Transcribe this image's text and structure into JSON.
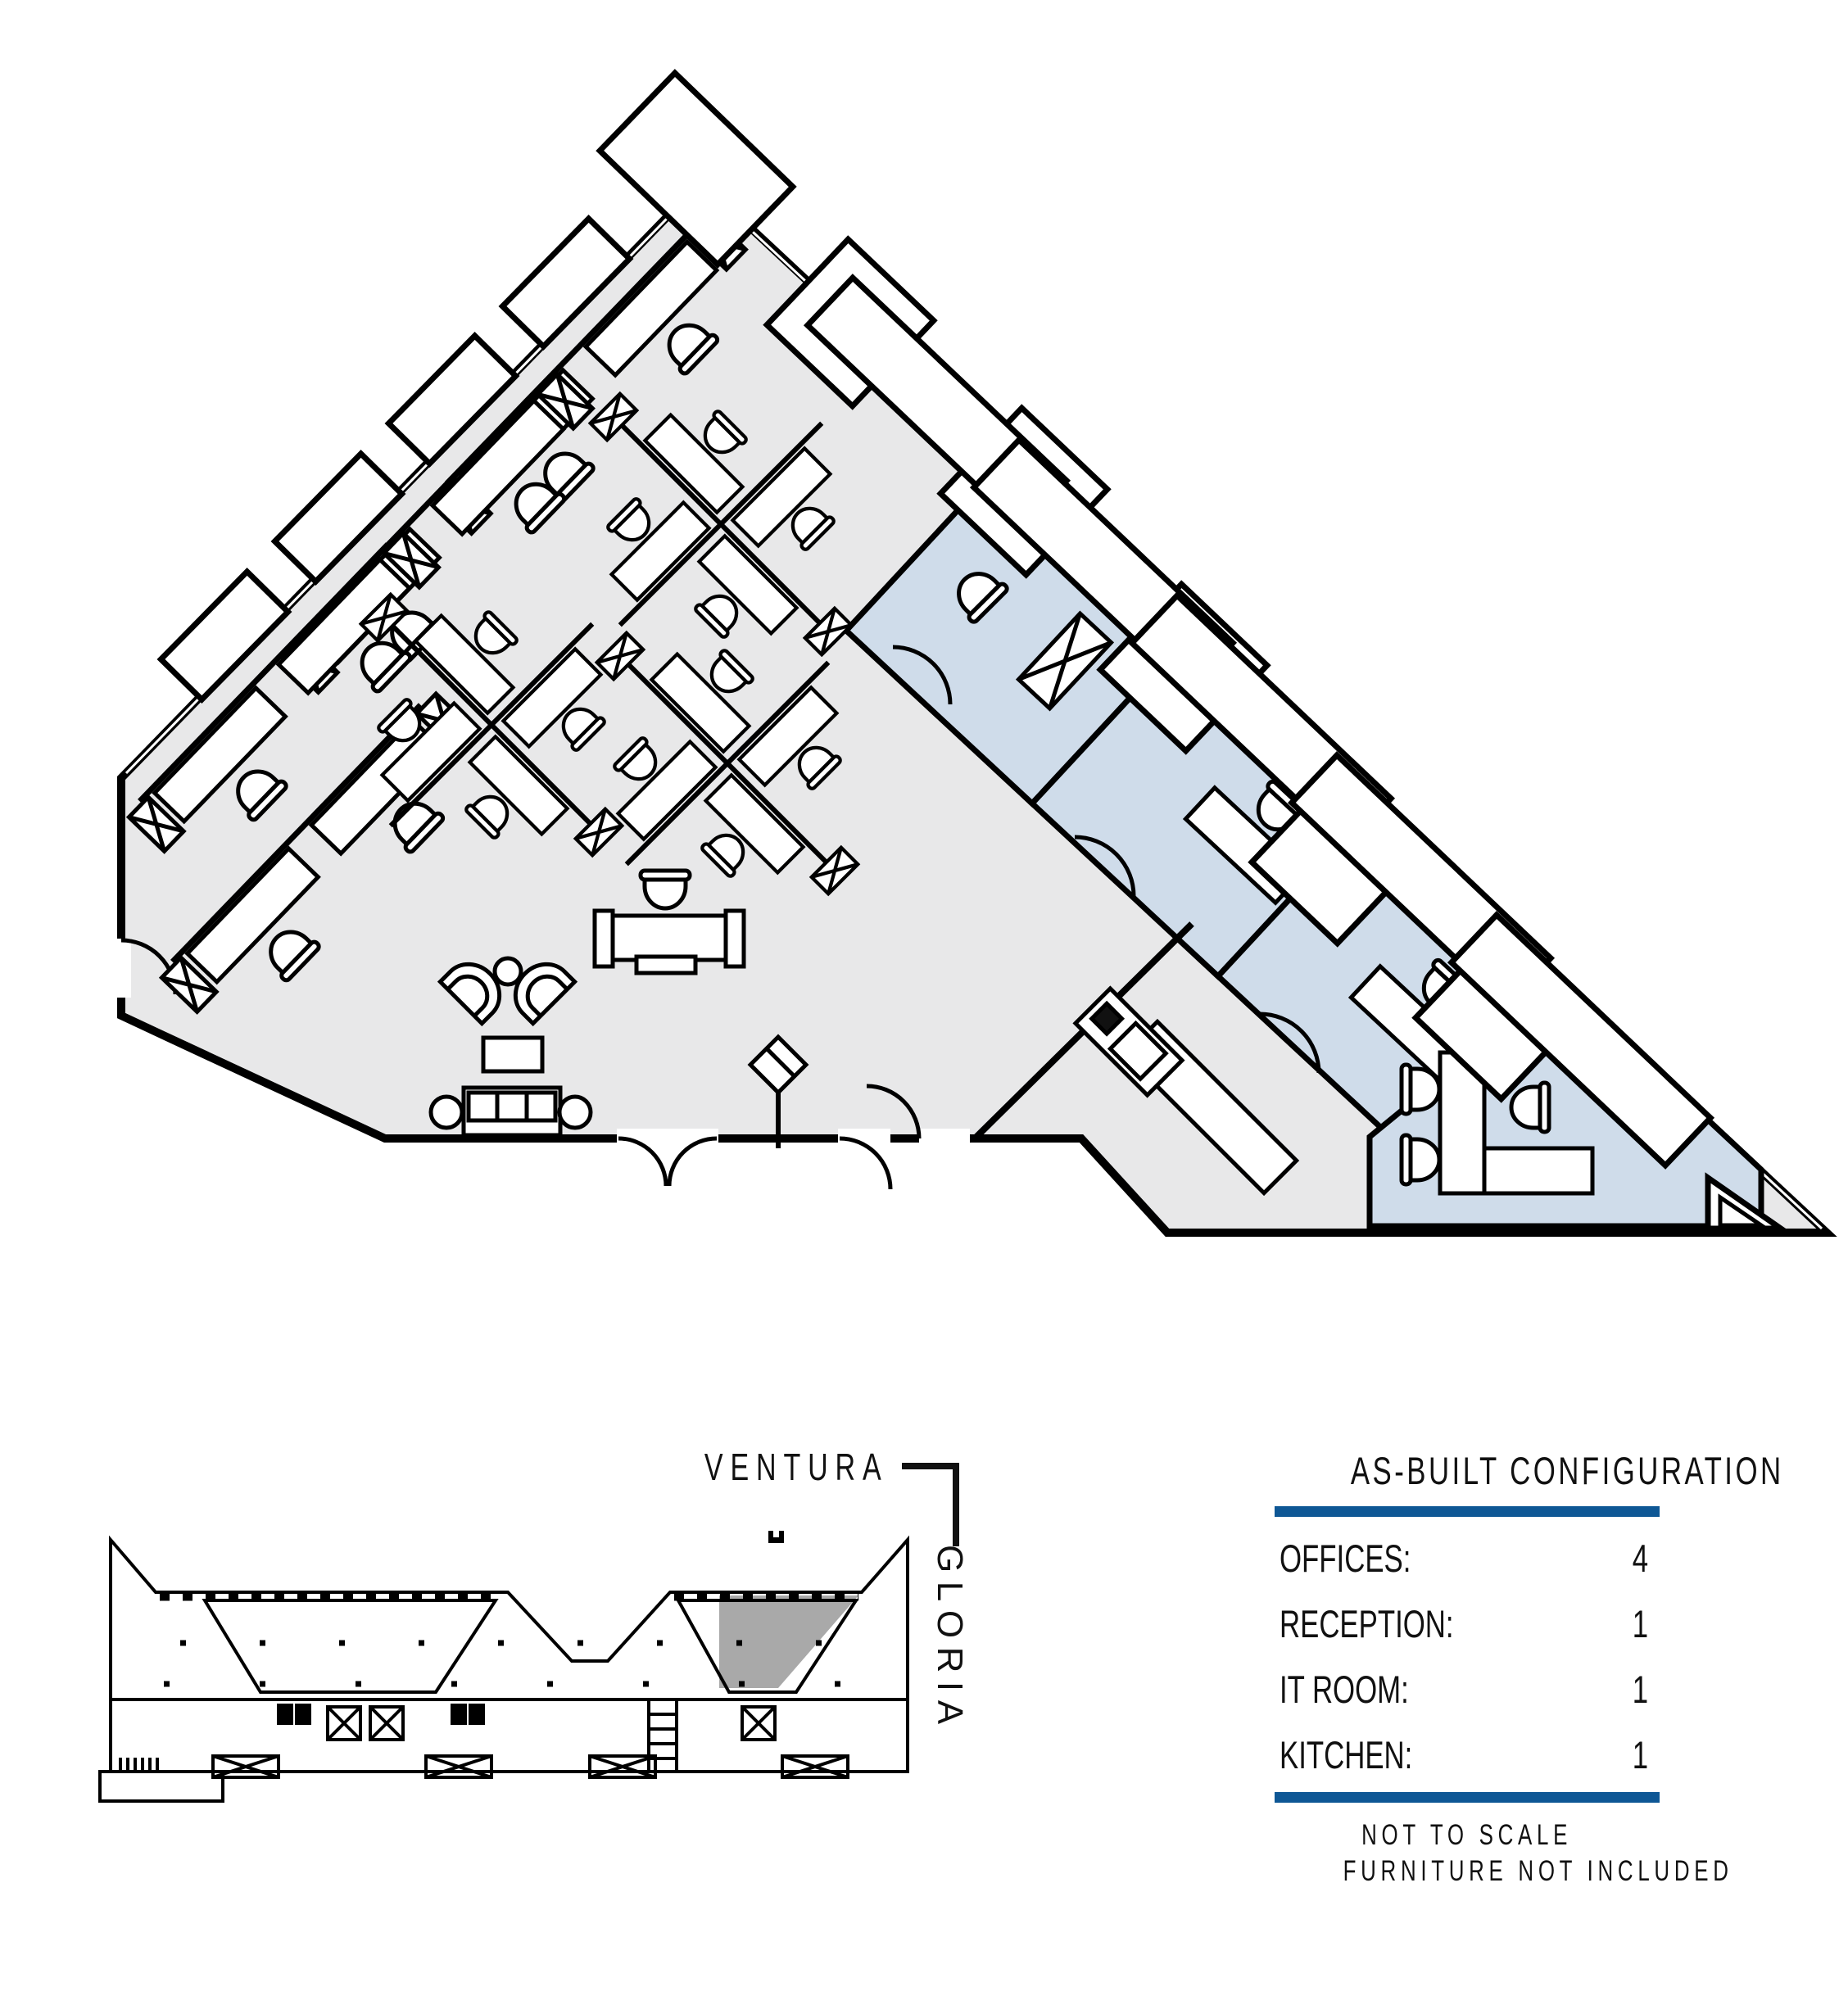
{
  "sheet": {
    "type": "office floor plan marketing sheet",
    "background": "#ffffff"
  },
  "colors": {
    "floor_gray": "#e8e8e9",
    "office_blue": "#cfdcea",
    "wall_black": "#000000",
    "accent_blue": "#0e5795",
    "keyplan_highlight": "#a9a9a9",
    "text_dark": "#111111"
  },
  "streets": {
    "ventura": "VENTURA",
    "gloria": "GLORIA"
  },
  "legend": {
    "title": "AS-BUILT CONFIGURATION",
    "rows": [
      {
        "label": "OFFICES:",
        "value": "4"
      },
      {
        "label": "RECEPTION:",
        "value": "1"
      },
      {
        "label": "IT ROOM:",
        "value": "1"
      },
      {
        "label": "KITCHEN:",
        "value": "1"
      }
    ],
    "notes": [
      "NOT TO SCALE",
      "FURNITURE NOT INCLUDED"
    ]
  }
}
